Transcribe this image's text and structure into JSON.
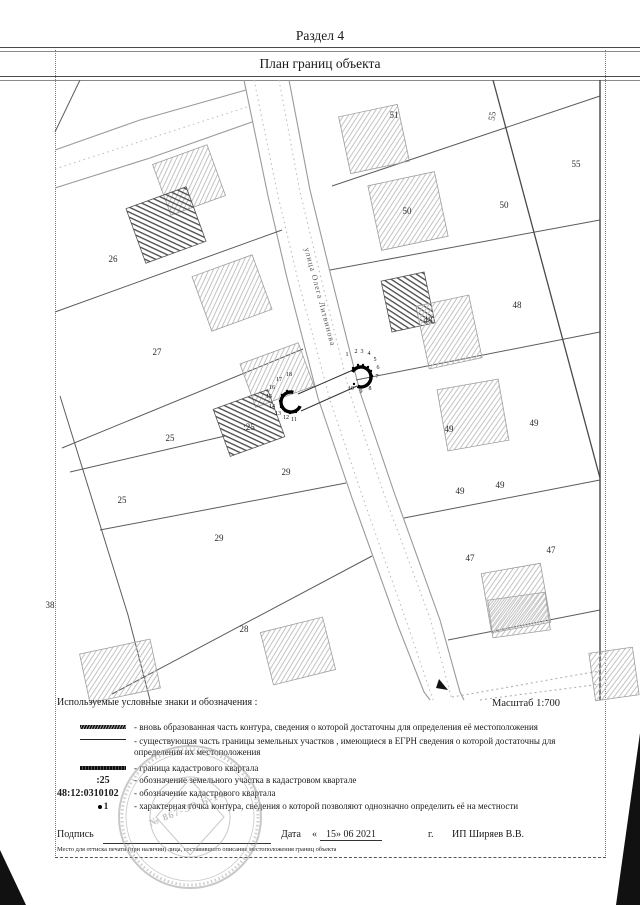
{
  "document": {
    "section_title": "Раздел 4",
    "page_title": "План границ объекта"
  },
  "map": {
    "street_label": "улица Олега Литвинова",
    "scale_label": "Масштаб 1:700",
    "parcel_labels": [
      {
        "text": "26",
        "x": 113,
        "y": 259
      },
      {
        "text": "27",
        "x": 157,
        "y": 352
      },
      {
        "text": "25",
        "x": 170,
        "y": 438
      },
      {
        "text": "25",
        "x": 122,
        "y": 500
      },
      {
        "text": "29",
        "x": 286,
        "y": 472
      },
      {
        "text": "29",
        "x": 219,
        "y": 538
      },
      {
        "text": "28",
        "x": 244,
        "y": 629
      },
      {
        "text": "38",
        "x": 50,
        "y": 605
      },
      {
        "text": "51",
        "x": 394,
        "y": 115
      },
      {
        "text": "55",
        "x": 492,
        "y": 116,
        "rot": -80
      },
      {
        "text": "55",
        "x": 576,
        "y": 164
      },
      {
        "text": "50",
        "x": 407,
        "y": 211
      },
      {
        "text": "50",
        "x": 504,
        "y": 205
      },
      {
        "text": "48",
        "x": 428,
        "y": 320
      },
      {
        "text": "48",
        "x": 517,
        "y": 305
      },
      {
        "text": "49",
        "x": 449,
        "y": 429
      },
      {
        "text": "49",
        "x": 534,
        "y": 423
      },
      {
        "text": "49",
        "x": 460,
        "y": 491
      },
      {
        "text": "49",
        "x": 500,
        "y": 485
      },
      {
        "text": "47",
        "x": 470,
        "y": 558
      },
      {
        "text": "47",
        "x": 551,
        "y": 550
      },
      {
        "text": ":25",
        "x": 249,
        "y": 427
      }
    ],
    "point_labels": [
      {
        "text": "18",
        "x": 289,
        "y": 375
      },
      {
        "text": "17",
        "x": 279,
        "y": 380
      },
      {
        "text": "16",
        "x": 272,
        "y": 388
      },
      {
        "text": "15",
        "x": 269,
        "y": 397
      },
      {
        "text": "14",
        "x": 272,
        "y": 407
      },
      {
        "text": "13",
        "x": 278,
        "y": 414
      },
      {
        "text": "12",
        "x": 286,
        "y": 418
      },
      {
        "text": "11",
        "x": 294,
        "y": 420
      },
      {
        "text": "1",
        "x": 347,
        "y": 355
      },
      {
        "text": "2",
        "x": 356,
        "y": 352
      },
      {
        "text": "3",
        "x": 362,
        "y": 352
      },
      {
        "text": "4",
        "x": 369,
        "y": 354
      },
      {
        "text": "5",
        "x": 375,
        "y": 360
      },
      {
        "text": "6",
        "x": 378,
        "y": 368
      },
      {
        "text": "7",
        "x": 377,
        "y": 377
      },
      {
        "text": "8",
        "x": 370,
        "y": 389
      },
      {
        "text": "9",
        "x": 361,
        "y": 392
      },
      {
        "text": "10",
        "x": 351,
        "y": 389
      }
    ]
  },
  "legend": {
    "title": "Используемые условные знаки и обозначения :",
    "items": [
      {
        "symbol": "new-contour-line",
        "text": "- вновь образованная часть контура, сведения о которой достаточны для определения её местоположения"
      },
      {
        "symbol": "existing-boundary-line",
        "text": "- существующая часть границы земельных участков , имеющиеся в ЕГРН сведения о которой достаточны для определения их местоположения"
      },
      {
        "symbol": "quarter-boundary-line",
        "text": "- граница кадастрового квартала"
      },
      {
        "symbol": "parcel-designation",
        "symbol_label": ":25",
        "text": "- обозначение земельного участка в кадастровом квартале"
      },
      {
        "symbol": "quarter-designation",
        "symbol_label": "48:12:0310102",
        "text": "- обозначение кадастрового квартала"
      },
      {
        "symbol": "characteristic-point",
        "symbol_label": "1",
        "text": "- характерная точка контура, сведения о которой позволяют однозначно определить её на местности"
      }
    ]
  },
  "footer": {
    "signature_label": "Подпись",
    "date_label": "Дата",
    "date_open": "«",
    "date_value": "15» 06  2021",
    "date_year_suffix": "г.",
    "executor": "ИП Ширяев В.В.",
    "stamp_number": "№ 867-ЭР-Б-14",
    "stamp_note": "Место для оттиска печати (при наличии) лица, составившего описание местоположения границ объекта"
  }
}
